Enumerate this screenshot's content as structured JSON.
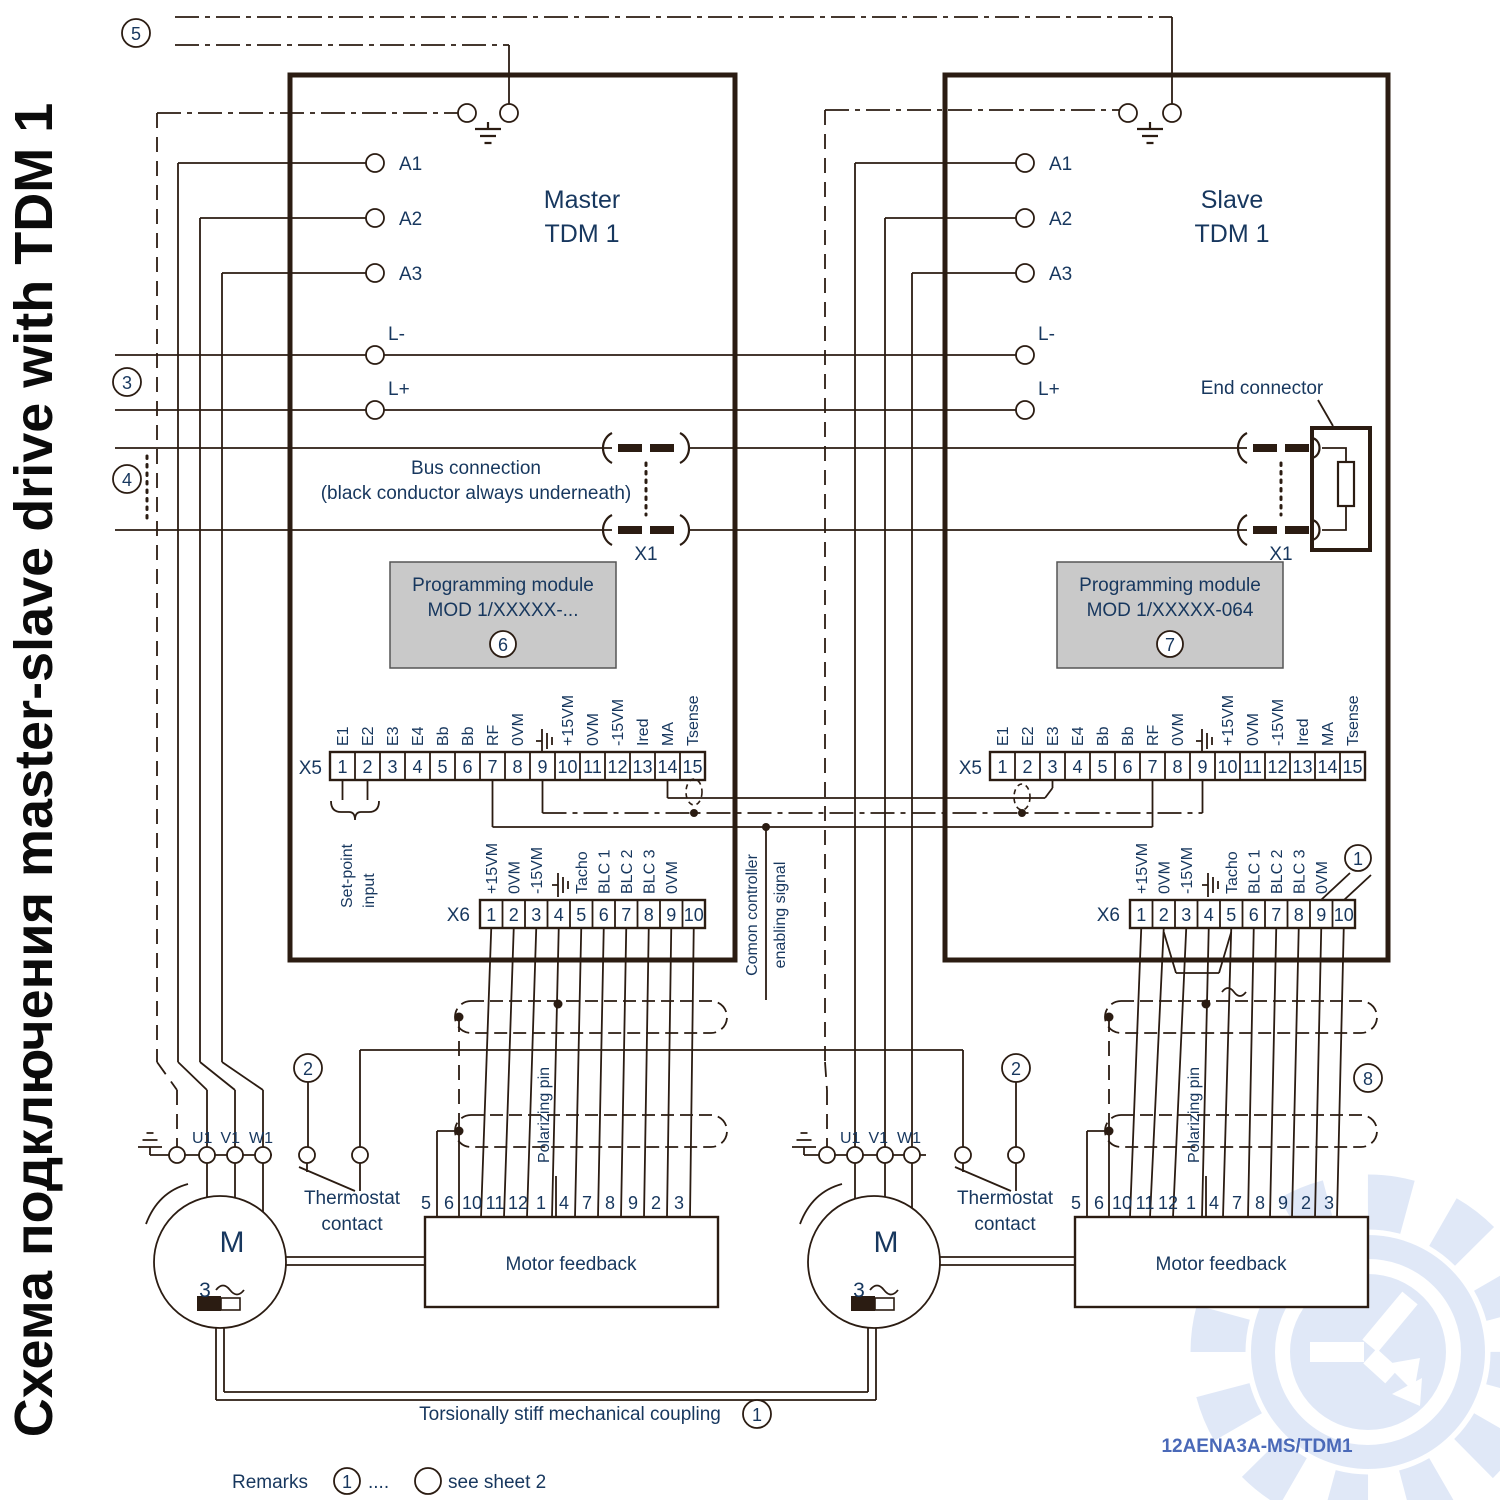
{
  "page": {
    "title_vertical": "Схема подключения master-slave drive with TDM 1",
    "doc_number": "12AENA3A-MS/TDM1"
  },
  "drives": {
    "master": {
      "title1": "Master",
      "title2": "TDM 1",
      "module1": "Programming module",
      "module2": "MOD 1/XXXXX-...",
      "badge": "6"
    },
    "slave": {
      "title1": "Slave",
      "title2": "TDM 1",
      "module1": "Programming module",
      "module2": "MOD 1/XXXXX-064",
      "badge": "7",
      "end_connector": "End connector"
    }
  },
  "labels": {
    "a_terminals": [
      "A1",
      "A2",
      "A3"
    ],
    "l_minus": "L-",
    "l_plus": "L+",
    "bus1": "Bus connection",
    "bus2": "(black conductor always underneath)",
    "x1": "X1",
    "setpoint1": "Set-point",
    "setpoint2": "input",
    "common1": "Comon controller",
    "common2": "enabling signal",
    "polarizing": "Polarizing pin",
    "thermostat1": "Thermostat",
    "thermostat2": "contact",
    "motor_letter": "M",
    "motor_phase": "3",
    "motor_terminals": [
      "U1",
      "V1",
      "W1"
    ],
    "feedback": "Motor feedback",
    "coupling": "Torsionally stiff mechanical coupling"
  },
  "x5": {
    "name": "X5",
    "pins": [
      "1",
      "2",
      "3",
      "4",
      "5",
      "6",
      "7",
      "8",
      "9",
      "10",
      "11",
      "12",
      "13",
      "14",
      "15"
    ],
    "signals": [
      "E1",
      "E2",
      "E3",
      "E4",
      "Bb",
      "Bb",
      "RF",
      "0VM",
      "",
      "+15VM",
      "0VM",
      "-15VM",
      "Ired",
      "MA",
      "Tsense"
    ]
  },
  "x6": {
    "name": "X6",
    "pins": [
      "1",
      "2",
      "3",
      "4",
      "5",
      "6",
      "7",
      "8",
      "9",
      "10"
    ],
    "signals": [
      "+15VM",
      "0VM",
      "-15VM",
      "",
      "Tacho",
      "BLC 1",
      "BLC 2",
      "BLC 3",
      "0VM",
      ""
    ]
  },
  "fb_pins": [
    "5",
    "6",
    "10",
    "11",
    "12",
    "1",
    "4",
    "7",
    "8",
    "9",
    "2",
    "3"
  ],
  "badges": {
    "n1": "1",
    "n2": "2",
    "n3": "3",
    "n4": "4",
    "n5": "5",
    "n6": "6",
    "n7": "7",
    "n8": "8"
  },
  "remarks": {
    "label": "Remarks",
    "badge": "1",
    "dots": "....",
    "text": "see sheet 2"
  }
}
